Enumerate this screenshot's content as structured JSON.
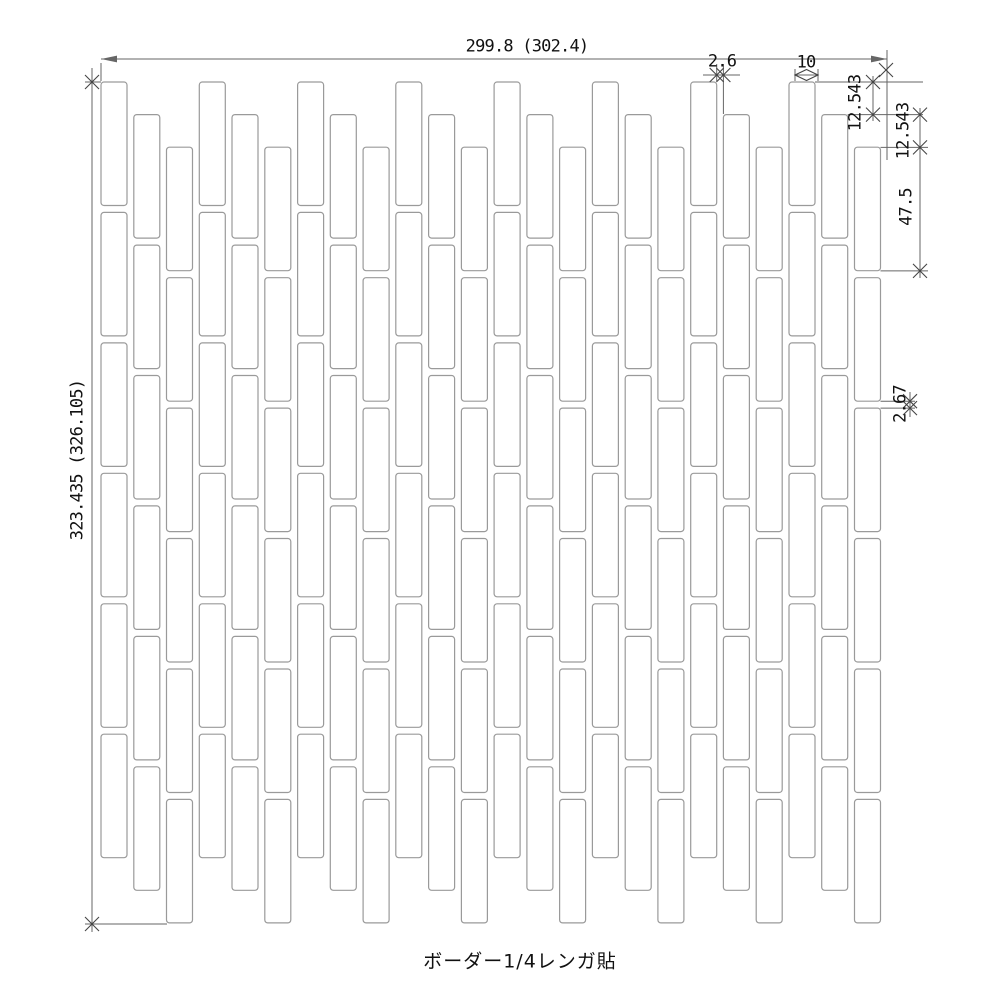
{
  "drawing": {
    "caption": "ボーダー1/4レンガ貼",
    "dimensions": {
      "overall_width": "299.8 (302.4)",
      "overall_height": "323.435 (326.105)",
      "horizontal_joint": "2.6",
      "tile_width": "10",
      "stagger_offset_1": "12.543",
      "stagger_offset_2": "12.543",
      "tile_height": "47.5",
      "vertical_joint": "2.67"
    },
    "pattern": {
      "columns": 24,
      "tiles_per_column": 6,
      "stagger_cycle": 3,
      "tile_w_units": 10,
      "tile_h_units": 47.5,
      "joint_w_units": 2.6,
      "joint_h_units": 2.67,
      "offset_units": 12.543
    },
    "colors": {
      "background": "#ffffff",
      "tile_fill": "#ffffff",
      "tile_border": "#9a9a9a",
      "dim_line": "#666666",
      "tick": "#444444",
      "text": "#111111"
    }
  }
}
